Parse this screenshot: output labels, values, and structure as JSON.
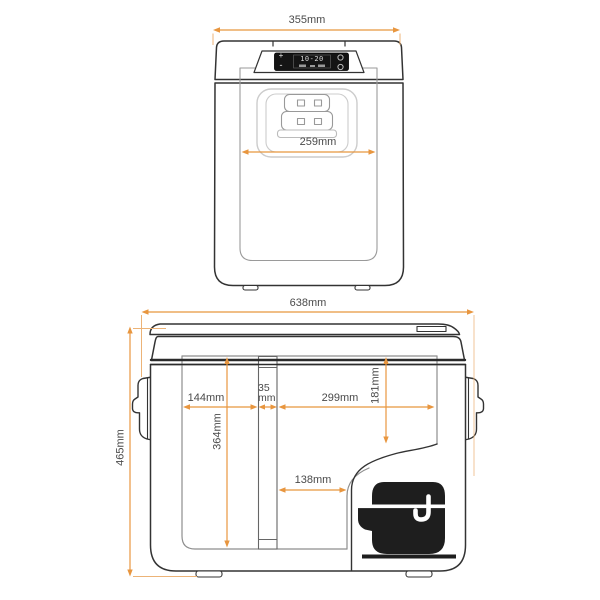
{
  "diagram_title": "Portable fridge dimension diagram (front and side views)",
  "colors": {
    "dimension_line": "#E8963F",
    "extension_line": "#ECB377",
    "label_text": "#4a4a4a",
    "outline": "#333333",
    "inner_line": "#8e8e8e",
    "compressor_fill": "#1e1e1e"
  },
  "front_view": {
    "display": {
      "plus_label": "+",
      "minus_label": "-",
      "readout": "10-20"
    },
    "dimensions": {
      "overall_width": "355mm",
      "lid_recess_width": "259mm"
    }
  },
  "side_view": {
    "dimensions": {
      "overall_length": "638mm",
      "overall_height": "465mm",
      "left_compartment_length": "144mm",
      "divider_width": "35\nmm",
      "right_compartment_length": "299mm",
      "right_compartment_depth": "181mm",
      "interior_depth": "364mm",
      "compressor_side_length": "138mm"
    }
  },
  "icons": {
    "compressor": "compressor-silhouette",
    "display_button_top": "round-button",
    "display_button_bottom": "round-button",
    "side_handles": "folding-carry-handle"
  }
}
